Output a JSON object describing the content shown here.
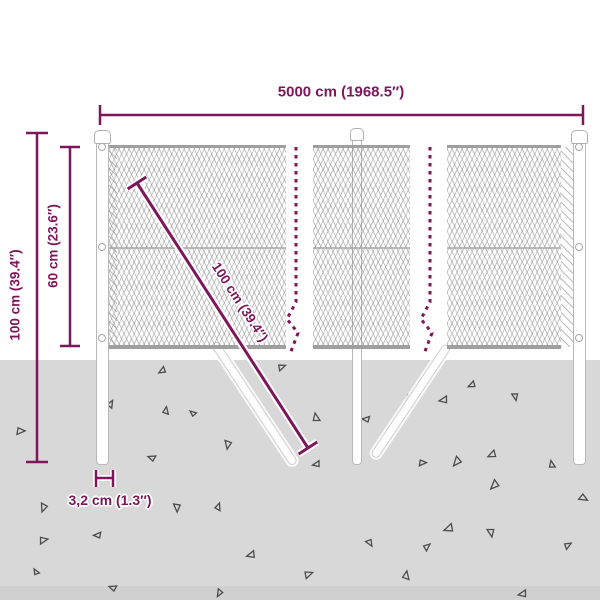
{
  "figure": {
    "type": "product-dimension-diagram",
    "subject": "chain-link fence with posts, ground anchoring struts and dimension callouts"
  },
  "colors": {
    "accent": "#7d165a",
    "ground": "#d8d8d8",
    "mesh_line": "#8c8c8c",
    "mesh_edge": "#9f9f9f",
    "post_fill": "#ffffff",
    "post_border": "#b8b8b8",
    "debris": "#4c4c4c"
  },
  "labels": {
    "total_width": "5000 cm (1968.5″)",
    "total_height": "100 cm (39.4″)",
    "mesh_height": "60 cm (23.6″)",
    "strut_length": "100 cm (39.4″)",
    "post_diameter": "3,2 cm (1.3″)"
  },
  "triangles": [
    [
      160,
      366,
      7,
      10
    ],
    [
      283,
      372,
      7,
      200
    ],
    [
      470,
      380,
      7,
      15
    ],
    [
      115,
      407,
      7,
      160
    ],
    [
      171,
      412,
      7,
      140
    ],
    [
      20,
      437,
      8,
      220
    ],
    [
      222,
      443,
      8,
      320
    ],
    [
      154,
      453,
      7,
      60
    ],
    [
      322,
      417,
      8,
      120
    ],
    [
      408,
      403,
      7,
      230
    ],
    [
      443,
      394,
      8,
      30
    ],
    [
      510,
      397,
      7,
      300
    ],
    [
      367,
      414,
      7,
      45
    ],
    [
      452,
      457,
      9,
      350
    ],
    [
      422,
      468,
      7,
      220
    ],
    [
      490,
      449,
      8,
      15
    ],
    [
      557,
      464,
      7,
      120
    ],
    [
      490,
      480,
      9,
      355
    ],
    [
      447,
      522,
      9,
      20
    ],
    [
      485,
      533,
      8,
      300
    ],
    [
      430,
      551,
      7,
      180
    ],
    [
      580,
      503,
      8,
      250
    ],
    [
      38,
      505,
      8,
      330
    ],
    [
      98,
      530,
      7,
      40
    ],
    [
      44,
      546,
      8,
      210
    ],
    [
      171,
      507,
      8,
      310
    ],
    [
      223,
      509,
      7,
      150
    ],
    [
      250,
      549,
      8,
      25
    ],
    [
      310,
      580,
      8,
      200
    ],
    [
      115,
      583,
      7,
      60
    ],
    [
      40,
      570,
      6,
      100
    ],
    [
      215,
      590,
      7,
      340
    ],
    [
      365,
      545,
      7,
      280
    ],
    [
      412,
      577,
      8,
      140
    ],
    [
      522,
      588,
      8,
      30
    ],
    [
      570,
      550,
      7,
      190
    ],
    [
      316,
      459,
      7,
      30
    ],
    [
      196,
      410,
      6,
      80
    ]
  ]
}
